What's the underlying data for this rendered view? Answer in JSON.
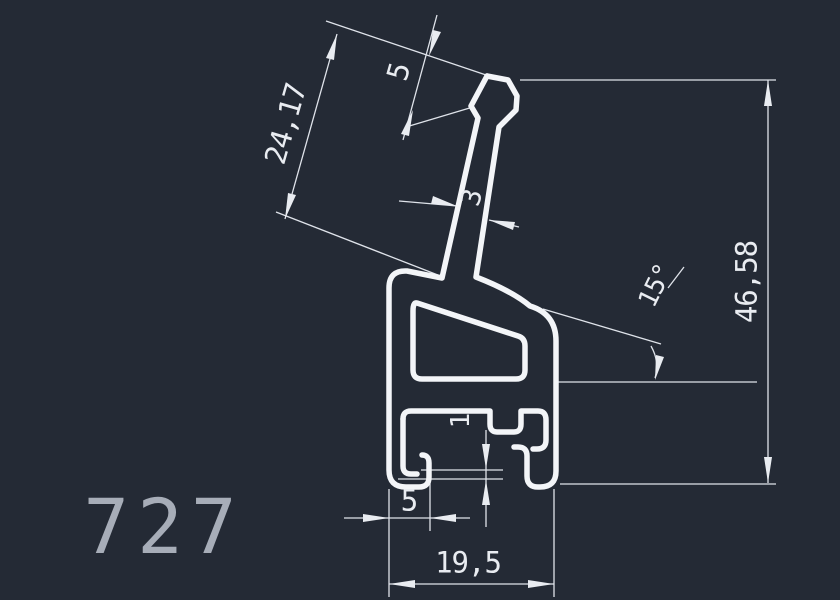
{
  "part_number": "727",
  "drawing": {
    "type": "extrusion-profile-cross-section",
    "units_style": "decimal-comma"
  },
  "dimensions": {
    "stem_length": "24,17",
    "tip_width": "5",
    "stem_thickness": "3",
    "stem_angle": "15°",
    "total_height": "46,58",
    "bottom_wall_thickness": "1",
    "foot_width": "5",
    "overall_width": "19,5"
  },
  "colors": {
    "background": "#242a35",
    "profile_line": "#f3f5f8",
    "dimension_line": "#dfe3ea",
    "dimension_text": "#e9ecf1",
    "part_number_text": "#a7adb8"
  }
}
